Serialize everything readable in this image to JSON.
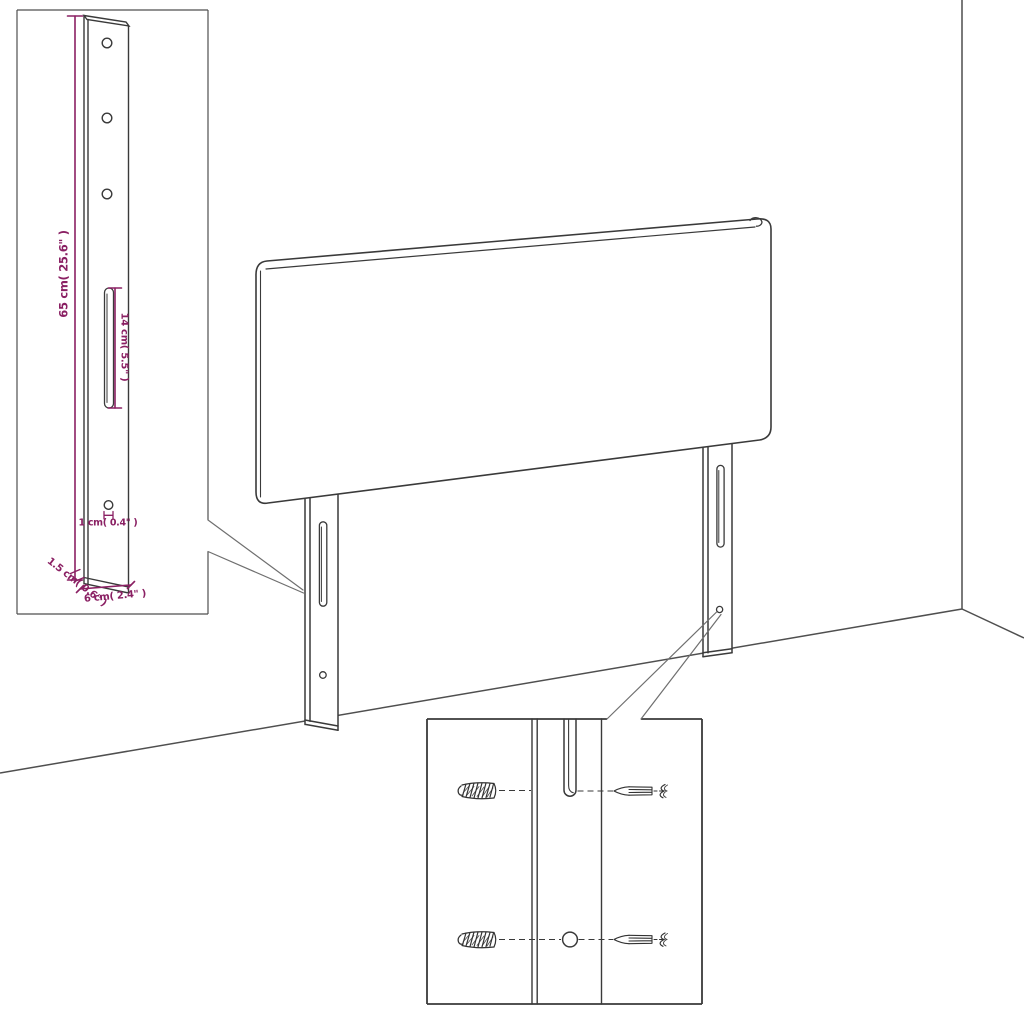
{
  "colors": {
    "dimension": "#8a2063",
    "outline": "#3a3a3a",
    "wall": "#4f4f4f",
    "callout": "#6f6f6f",
    "screw": "#333333",
    "background": "#ffffff"
  },
  "dimensions": {
    "bracket_height": "65 cm( 25.6\" )",
    "slot_length": "14 cm( 5.5\" )",
    "hole_diameter": "1 cm( 0.4\" )",
    "bracket_depth": "1.5 cm( 0.6\" )",
    "bracket_width": "6 cm( 2.4\" )"
  }
}
